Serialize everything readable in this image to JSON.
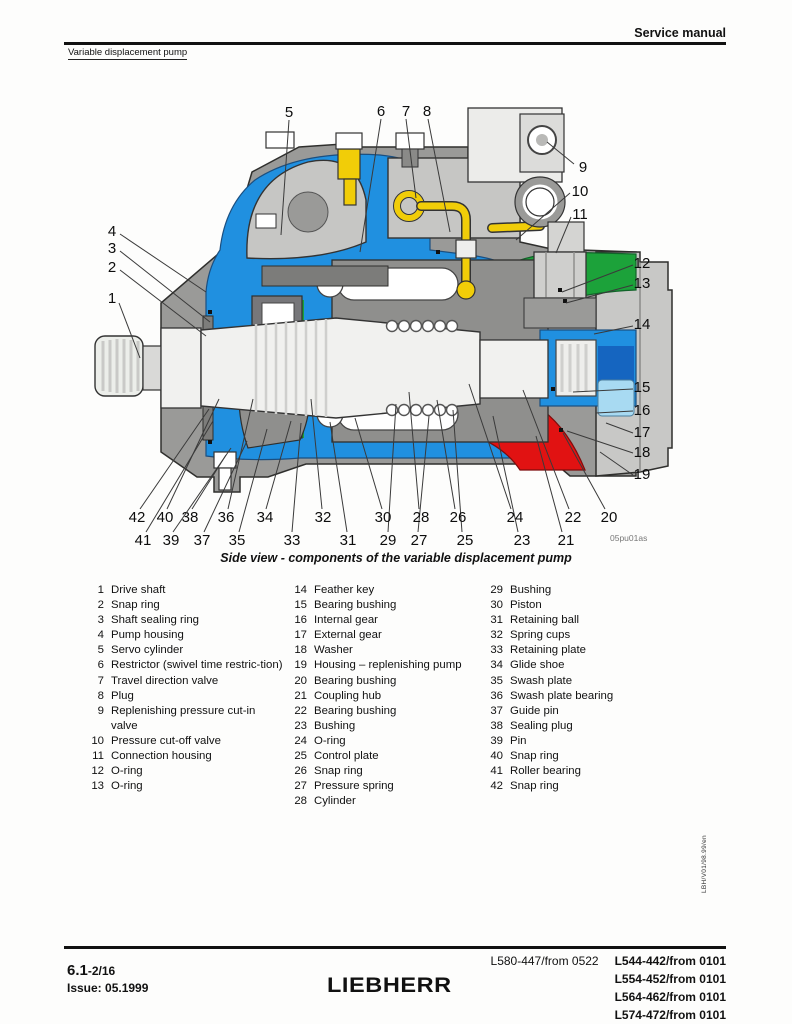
{
  "header": {
    "manual_title": "Service manual",
    "section_title": "Variable displacement pump"
  },
  "figure": {
    "caption": "Side view - components of the variable displacement pump",
    "drawing_code": "05pu01as",
    "colors": {
      "housing_gray": "#9a9a98",
      "end_cap_gray": "#c8c8c6",
      "hydraulic_blue": "#2090e0",
      "deep_blue": "#1565c0",
      "light_blue": "#a8daf2",
      "suction_green": "#1ca23a",
      "pressure_red": "#e11212",
      "pilot_yellow": "#f1cd08"
    },
    "callouts": [
      {
        "n": "1",
        "x": 112,
        "y": 298,
        "x1": 119,
        "y1": 303,
        "x2": 140,
        "y2": 358
      },
      {
        "n": "2",
        "x": 112,
        "y": 267,
        "x1": 120,
        "y1": 270,
        "x2": 206,
        "y2": 336
      },
      {
        "n": "3",
        "x": 112,
        "y": 248,
        "x1": 120,
        "y1": 251,
        "x2": 210,
        "y2": 322
      },
      {
        "n": "4",
        "x": 112,
        "y": 231,
        "x1": 120,
        "y1": 234,
        "x2": 206,
        "y2": 292
      },
      {
        "n": "5",
        "x": 289,
        "y": 112,
        "x1": 289,
        "y1": 120,
        "x2": 281,
        "y2": 235
      },
      {
        "n": "6",
        "x": 381,
        "y": 111,
        "x1": 381,
        "y1": 119,
        "x2": 360,
        "y2": 252
      },
      {
        "n": "7",
        "x": 406,
        "y": 111,
        "x1": 406,
        "y1": 119,
        "x2": 416,
        "y2": 198
      },
      {
        "n": "8",
        "x": 427,
        "y": 111,
        "x1": 428,
        "y1": 119,
        "x2": 450,
        "y2": 232
      },
      {
        "n": "9",
        "x": 583,
        "y": 167,
        "x1": 574,
        "y1": 164,
        "x2": 547,
        "y2": 142
      },
      {
        "n": "10",
        "x": 580,
        "y": 191,
        "x1": 570,
        "y1": 193,
        "x2": 516,
        "y2": 240
      },
      {
        "n": "11",
        "x": 580,
        "y": 214,
        "x1": 571,
        "y1": 217,
        "x2": 556,
        "y2": 253
      },
      {
        "n": "12",
        "x": 642,
        "y": 263,
        "x1": 633,
        "y1": 265,
        "x2": 562,
        "y2": 292
      },
      {
        "n": "13",
        "x": 642,
        "y": 283,
        "x1": 633,
        "y1": 285,
        "x2": 566,
        "y2": 303
      },
      {
        "n": "14",
        "x": 642,
        "y": 324,
        "x1": 633,
        "y1": 326,
        "x2": 594,
        "y2": 334
      },
      {
        "n": "15",
        "x": 642,
        "y": 387,
        "x1": 633,
        "y1": 389,
        "x2": 573,
        "y2": 392
      },
      {
        "n": "16",
        "x": 642,
        "y": 410,
        "x1": 633,
        "y1": 411,
        "x2": 596,
        "y2": 413
      },
      {
        "n": "17",
        "x": 642,
        "y": 432,
        "x1": 633,
        "y1": 433,
        "x2": 606,
        "y2": 423
      },
      {
        "n": "18",
        "x": 642,
        "y": 452,
        "x1": 633,
        "y1": 453,
        "x2": 567,
        "y2": 431
      },
      {
        "n": "19",
        "x": 642,
        "y": 474,
        "x1": 633,
        "y1": 475,
        "x2": 600,
        "y2": 452
      },
      {
        "n": "20",
        "x": 609,
        "y": 517,
        "x1": 605,
        "y1": 509,
        "x2": 563,
        "y2": 433
      },
      {
        "n": "21",
        "x": 566,
        "y": 540,
        "x1": 562,
        "y1": 532,
        "x2": 536,
        "y2": 436
      },
      {
        "n": "22",
        "x": 573,
        "y": 517,
        "x1": 569,
        "y1": 509,
        "x2": 523,
        "y2": 390
      },
      {
        "n": "23",
        "x": 522,
        "y": 540,
        "x1": 518,
        "y1": 532,
        "x2": 493,
        "y2": 416
      },
      {
        "n": "24",
        "x": 515,
        "y": 517,
        "x1": 511,
        "y1": 509,
        "x2": 469,
        "y2": 384
      },
      {
        "n": "25",
        "x": 465,
        "y": 540,
        "x1": 462,
        "y1": 532,
        "x2": 453,
        "y2": 410
      },
      {
        "n": "26",
        "x": 458,
        "y": 517,
        "x1": 455,
        "y1": 509,
        "x2": 437,
        "y2": 400
      },
      {
        "n": "27",
        "x": 419,
        "y": 540,
        "x1": 418,
        "y1": 532,
        "x2": 429,
        "y2": 416
      },
      {
        "n": "28",
        "x": 421,
        "y": 517,
        "x1": 419,
        "y1": 509,
        "x2": 409,
        "y2": 392
      },
      {
        "n": "29",
        "x": 388,
        "y": 540,
        "x1": 388,
        "y1": 532,
        "x2": 396,
        "y2": 404
      },
      {
        "n": "30",
        "x": 383,
        "y": 517,
        "x1": 382,
        "y1": 509,
        "x2": 355,
        "y2": 418
      },
      {
        "n": "31",
        "x": 348,
        "y": 540,
        "x1": 347,
        "y1": 532,
        "x2": 330,
        "y2": 422
      },
      {
        "n": "32",
        "x": 323,
        "y": 517,
        "x1": 322,
        "y1": 509,
        "x2": 311,
        "y2": 399
      },
      {
        "n": "33",
        "x": 292,
        "y": 540,
        "x1": 292,
        "y1": 532,
        "x2": 301,
        "y2": 423
      },
      {
        "n": "34",
        "x": 265,
        "y": 517,
        "x1": 266,
        "y1": 509,
        "x2": 291,
        "y2": 421
      },
      {
        "n": "35",
        "x": 237,
        "y": 540,
        "x1": 239,
        "y1": 532,
        "x2": 267,
        "y2": 429
      },
      {
        "n": "36",
        "x": 226,
        "y": 517,
        "x1": 228,
        "y1": 509,
        "x2": 253,
        "y2": 399
      },
      {
        "n": "37",
        "x": 202,
        "y": 540,
        "x1": 204,
        "y1": 532,
        "x2": 247,
        "y2": 441
      },
      {
        "n": "38",
        "x": 190,
        "y": 517,
        "x1": 192,
        "y1": 509,
        "x2": 226,
        "y2": 455
      },
      {
        "n": "39",
        "x": 171,
        "y": 540,
        "x1": 173,
        "y1": 532,
        "x2": 231,
        "y2": 448
      },
      {
        "n": "40",
        "x": 165,
        "y": 517,
        "x1": 167,
        "y1": 509,
        "x2": 219,
        "y2": 399
      },
      {
        "n": "41",
        "x": 143,
        "y": 540,
        "x1": 146,
        "y1": 532,
        "x2": 213,
        "y2": 421
      },
      {
        "n": "42",
        "x": 137,
        "y": 517,
        "x1": 140,
        "y1": 509,
        "x2": 209,
        "y2": 409
      }
    ]
  },
  "parts": {
    "columns": [
      [
        {
          "n": "1",
          "label": "Drive shaft"
        },
        {
          "n": "2",
          "label": "Snap ring"
        },
        {
          "n": "3",
          "label": "Shaft sealing ring"
        },
        {
          "n": "4",
          "label": "Pump housing"
        },
        {
          "n": "5",
          "label": "Servo cylinder"
        },
        {
          "n": "6",
          "label": "Restrictor (swivel time restric-tion)"
        },
        {
          "n": "7",
          "label": "Travel direction valve"
        },
        {
          "n": "8",
          "label": "Plug"
        },
        {
          "n": "9",
          "label": "Replenishing pressure cut-in valve"
        },
        {
          "n": "10",
          "label": "Pressure cut-off valve"
        },
        {
          "n": "11",
          "label": "Connection housing"
        },
        {
          "n": "12",
          "label": "O-ring"
        },
        {
          "n": "13",
          "label": "O-ring"
        }
      ],
      [
        {
          "n": "14",
          "label": "Feather key"
        },
        {
          "n": "15",
          "label": "Bearing bushing"
        },
        {
          "n": "16",
          "label": "Internal gear"
        },
        {
          "n": "17",
          "label": "External gear"
        },
        {
          "n": "18",
          "label": "Washer"
        },
        {
          "n": "19",
          "label": "Housing – replenishing pump"
        },
        {
          "n": "20",
          "label": "Bearing bushing"
        },
        {
          "n": "21",
          "label": "Coupling hub"
        },
        {
          "n": "22",
          "label": "Bearing bushing"
        },
        {
          "n": "23",
          "label": "Bushing"
        },
        {
          "n": "24",
          "label": "O-ring"
        },
        {
          "n": "25",
          "label": "Control plate"
        },
        {
          "n": "26",
          "label": "Snap ring"
        },
        {
          "n": "27",
          "label": "Pressure spring"
        },
        {
          "n": "28",
          "label": "Cylinder"
        }
      ],
      [
        {
          "n": "29",
          "label": "Bushing"
        },
        {
          "n": "30",
          "label": "Piston"
        },
        {
          "n": "31",
          "label": "Retaining ball"
        },
        {
          "n": "32",
          "label": "Spring cups"
        },
        {
          "n": "33",
          "label": "Retaining plate"
        },
        {
          "n": "34",
          "label": "Glide shoe"
        },
        {
          "n": "35",
          "label": "Swash plate"
        },
        {
          "n": "36",
          "label": "Swash plate bearing"
        },
        {
          "n": "37",
          "label": "Guide pin"
        },
        {
          "n": "38",
          "label": "Sealing plug"
        },
        {
          "n": "39",
          "label": "Pin"
        },
        {
          "n": "40",
          "label": "Snap ring"
        },
        {
          "n": "41",
          "label": "Roller bearing"
        },
        {
          "n": "42",
          "label": "Snap ring"
        }
      ]
    ]
  },
  "footer": {
    "page_code": "6.1",
    "page_suffix": "-2/16",
    "issue": "Issue: 05.1999",
    "logo": "LIEBHERR",
    "model_left": "L580-447/from 0522",
    "models_bold": [
      "L544-442/from 0101",
      "L554-452/from 0101",
      "L564-462/from 0101",
      "L574-472/from 0101"
    ]
  },
  "side_code": "LBH/V01/98.99/en"
}
